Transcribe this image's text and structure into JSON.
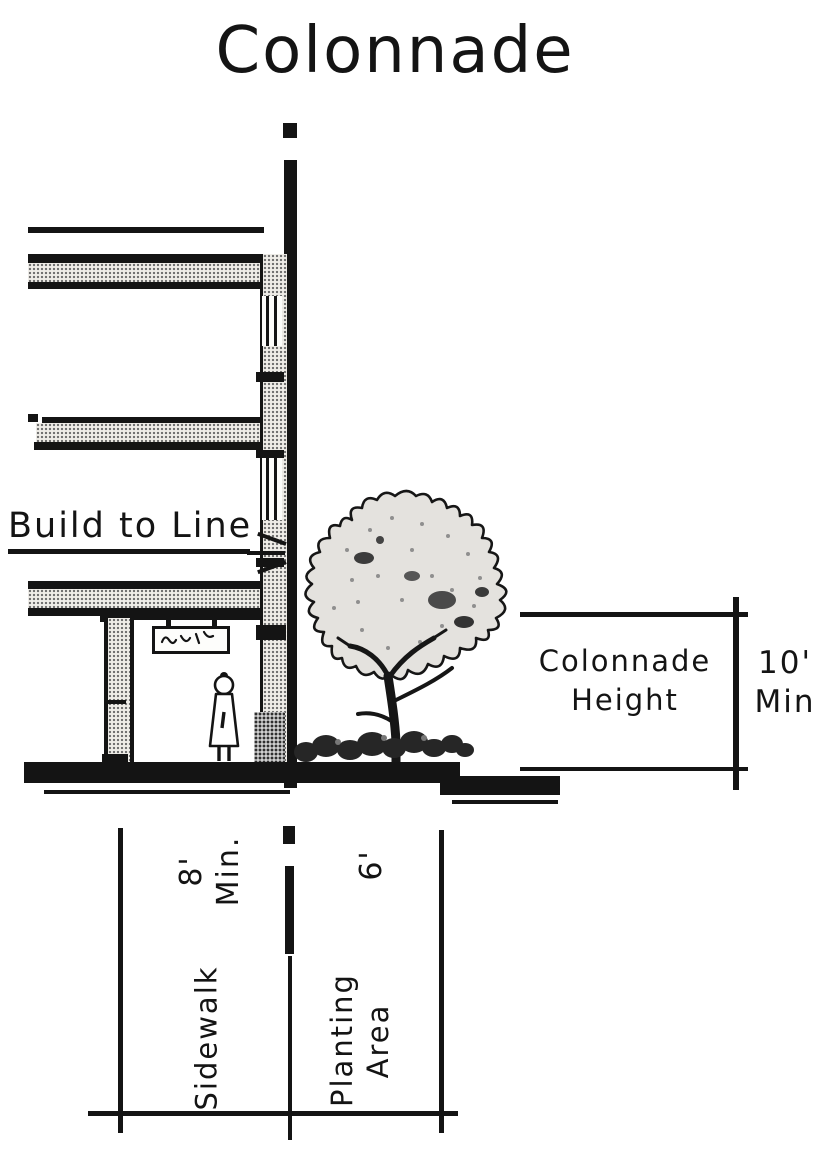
{
  "title": "Colonnade",
  "annotations": {
    "build_to_line": "Build to Line"
  },
  "dimensions": {
    "colonnade_height": {
      "label_line1": "Colonnade",
      "label_line2": "Height",
      "value": "10'",
      "qualifier": "Min"
    },
    "sidewalk": {
      "label": "Sidewalk",
      "value": "8'",
      "qualifier": "Min."
    },
    "planting_area": {
      "label_line1": "Planting",
      "label_line2": "Area",
      "value": "6'"
    }
  },
  "colors": {
    "ink": "#141414",
    "paper": "#ffffff",
    "halftone": "#6d6d6d"
  }
}
